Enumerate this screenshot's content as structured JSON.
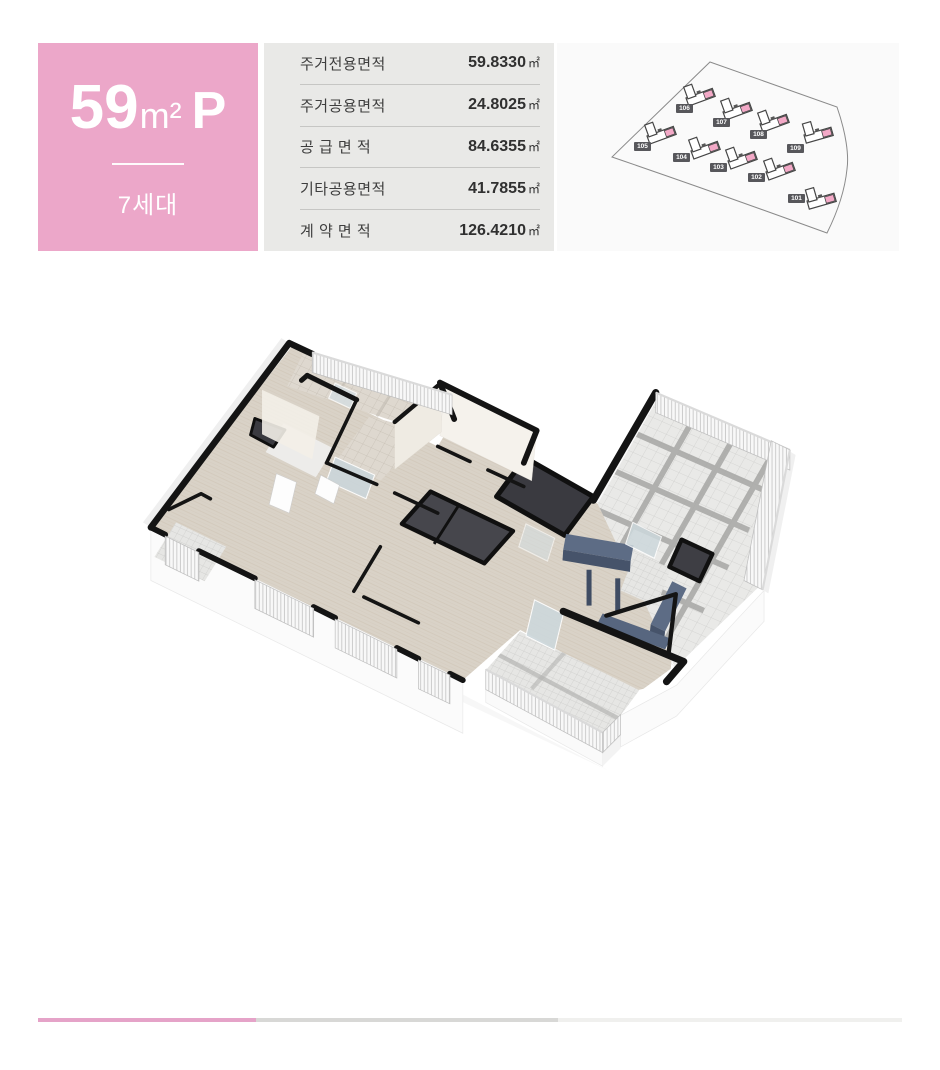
{
  "unit_card": {
    "number": "59",
    "unit": "m²",
    "suffix": "P",
    "household": "7세대"
  },
  "area_table": {
    "rows": [
      {
        "label": "주거전용면적",
        "value": "59.8330",
        "unit": "㎡"
      },
      {
        "label": "주거공용면적",
        "value": "24.8025",
        "unit": "㎡"
      },
      {
        "label": "공 급 면 적",
        "value": "84.6355",
        "unit": "㎡"
      },
      {
        "label": "기타공용면적",
        "value": "41.7855",
        "unit": "㎡"
      },
      {
        "label": "계 약 면 적",
        "value": "126.4210",
        "unit": "㎡"
      }
    ]
  },
  "site_plan": {
    "buildings": [
      {
        "id": "106"
      },
      {
        "id": "107"
      },
      {
        "id": "108"
      },
      {
        "id": "109"
      },
      {
        "id": "105"
      },
      {
        "id": "104"
      },
      {
        "id": "103"
      },
      {
        "id": "102"
      },
      {
        "id": "101"
      }
    ]
  },
  "colors": {
    "accent_pink": "#ECA7C9",
    "table_bg": "#E9E9E7",
    "siteplan_bg": "#FAFAFA",
    "badge_bg": "#57575B",
    "building_pink": "#F3A9C7",
    "wall_black": "#141414",
    "wood_floor": "#D9D2C7",
    "tile_gray": "#E9E9E7",
    "tile_beige": "#DED8CF",
    "kitchen_navy": "#5D6C85",
    "core_dark": "#3A3A40",
    "footer_pink": "#E5A3C8",
    "footer_gray": "#D8D8D6",
    "footer_light": "#F0F0EE"
  }
}
